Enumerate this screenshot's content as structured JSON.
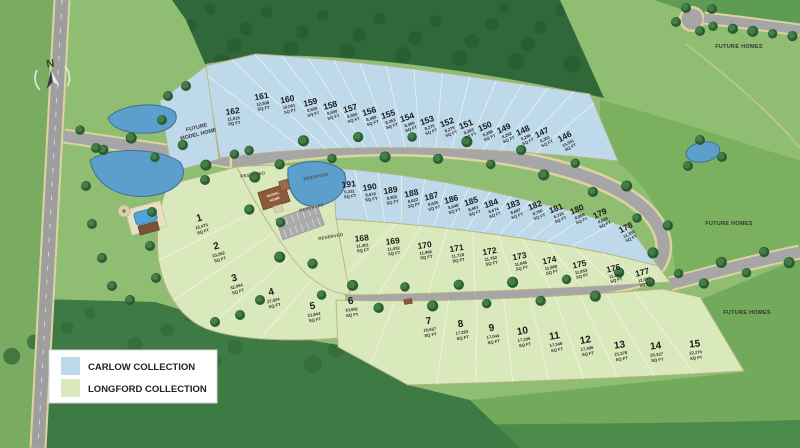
{
  "legend": {
    "items": [
      {
        "label": "CARLOW COLLECTION",
        "color": "#bdd9ea"
      },
      {
        "label": "LONGFORD COLLECTION",
        "color": "#d9e9bc"
      }
    ]
  },
  "collections": {
    "carlow": {
      "name": "CARLOW COLLECTION",
      "color": "#bdd9ea"
    },
    "longford": {
      "name": "LONGFORD COLLECTION",
      "color": "#d9e9bc"
    }
  },
  "compass": {
    "north_label": "N"
  },
  "map_labels": {
    "future_model_home_line1": "FUTURE",
    "future_model_home_line2": "MODEL HOME",
    "model_home_line1": "MODEL",
    "model_home_line2": "HOME",
    "reserved": "RESERVED",
    "future_homes": "FUTURE HOMES",
    "sq_ft_unit": "SQ FT"
  },
  "lots": {
    "carlow_top_row": [
      {
        "number": "162",
        "sqft": "11,615"
      },
      {
        "number": "161",
        "sqft": "12,508"
      },
      {
        "number": "160",
        "sqft": "10,061"
      },
      {
        "number": "159",
        "sqft": "8,550"
      },
      {
        "number": "158",
        "sqft": "8,550"
      },
      {
        "number": "157",
        "sqft": "8,550"
      },
      {
        "number": "156",
        "sqft": "8,489"
      },
      {
        "number": "155",
        "sqft": "8,353"
      },
      {
        "number": "154",
        "sqft": "8,466"
      },
      {
        "number": "153",
        "sqft": "8,275"
      },
      {
        "number": "152",
        "sqft": "8,279"
      },
      {
        "number": "151",
        "sqft": "8,283"
      },
      {
        "number": "150",
        "sqft": "8,288"
      },
      {
        "number": "149",
        "sqft": "8,292"
      },
      {
        "number": "148",
        "sqft": "8,296"
      },
      {
        "number": "147",
        "sqft": "8,301"
      },
      {
        "number": "146",
        "sqft": "10,551"
      }
    ],
    "carlow_inner_row": [
      {
        "number": "191",
        "sqft": "9,331"
      },
      {
        "number": "190",
        "sqft": "8,676"
      },
      {
        "number": "189",
        "sqft": "8,553"
      },
      {
        "number": "188",
        "sqft": "8,622"
      },
      {
        "number": "187",
        "sqft": "8,635"
      },
      {
        "number": "186",
        "sqft": "8,648"
      },
      {
        "number": "185",
        "sqft": "8,661"
      },
      {
        "number": "184",
        "sqft": "8,674"
      },
      {
        "number": "183",
        "sqft": "8,687"
      },
      {
        "number": "182",
        "sqft": "8,700"
      },
      {
        "number": "181",
        "sqft": "8,726"
      },
      {
        "number": "180",
        "sqft": "8,869"
      },
      {
        "number": "179",
        "sqft": "8,828"
      },
      {
        "number": "178",
        "sqft": "11,353"
      }
    ],
    "longford_inner_row": [
      {
        "number": "168",
        "sqft": "11,401"
      },
      {
        "number": "169",
        "sqft": "11,432"
      },
      {
        "number": "170",
        "sqft": "11,986"
      },
      {
        "number": "171",
        "sqft": "11,718"
      },
      {
        "number": "172",
        "sqft": "11,782"
      },
      {
        "number": "173",
        "sqft": "11,845"
      },
      {
        "number": "174",
        "sqft": "11,868"
      },
      {
        "number": "175",
        "sqft": "11,653"
      },
      {
        "number": "176",
        "sqft": "11,381"
      },
      {
        "number": "177",
        "sqft": "12,044"
      }
    ],
    "longford_west_row": [
      {
        "number": "1",
        "sqft": "15,473"
      },
      {
        "number": "2",
        "sqft": "23,262"
      },
      {
        "number": "3",
        "sqft": "32,954"
      },
      {
        "number": "4",
        "sqft": "27,824"
      },
      {
        "number": "5",
        "sqft": "21,844"
      }
    ],
    "longford_south_row": [
      {
        "number": "6",
        "sqft": "10,991"
      },
      {
        "number": "7",
        "sqft": "15,627"
      },
      {
        "number": "8",
        "sqft": "17,363"
      },
      {
        "number": "9",
        "sqft": "17,044"
      },
      {
        "number": "10",
        "sqft": "17,196"
      },
      {
        "number": "11",
        "sqft": "17,346"
      },
      {
        "number": "12",
        "sqft": "17,496"
      },
      {
        "number": "13",
        "sqft": "21,378"
      },
      {
        "number": "14",
        "sqft": "25,327"
      },
      {
        "number": "15",
        "sqft": "22,270"
      }
    ]
  }
}
